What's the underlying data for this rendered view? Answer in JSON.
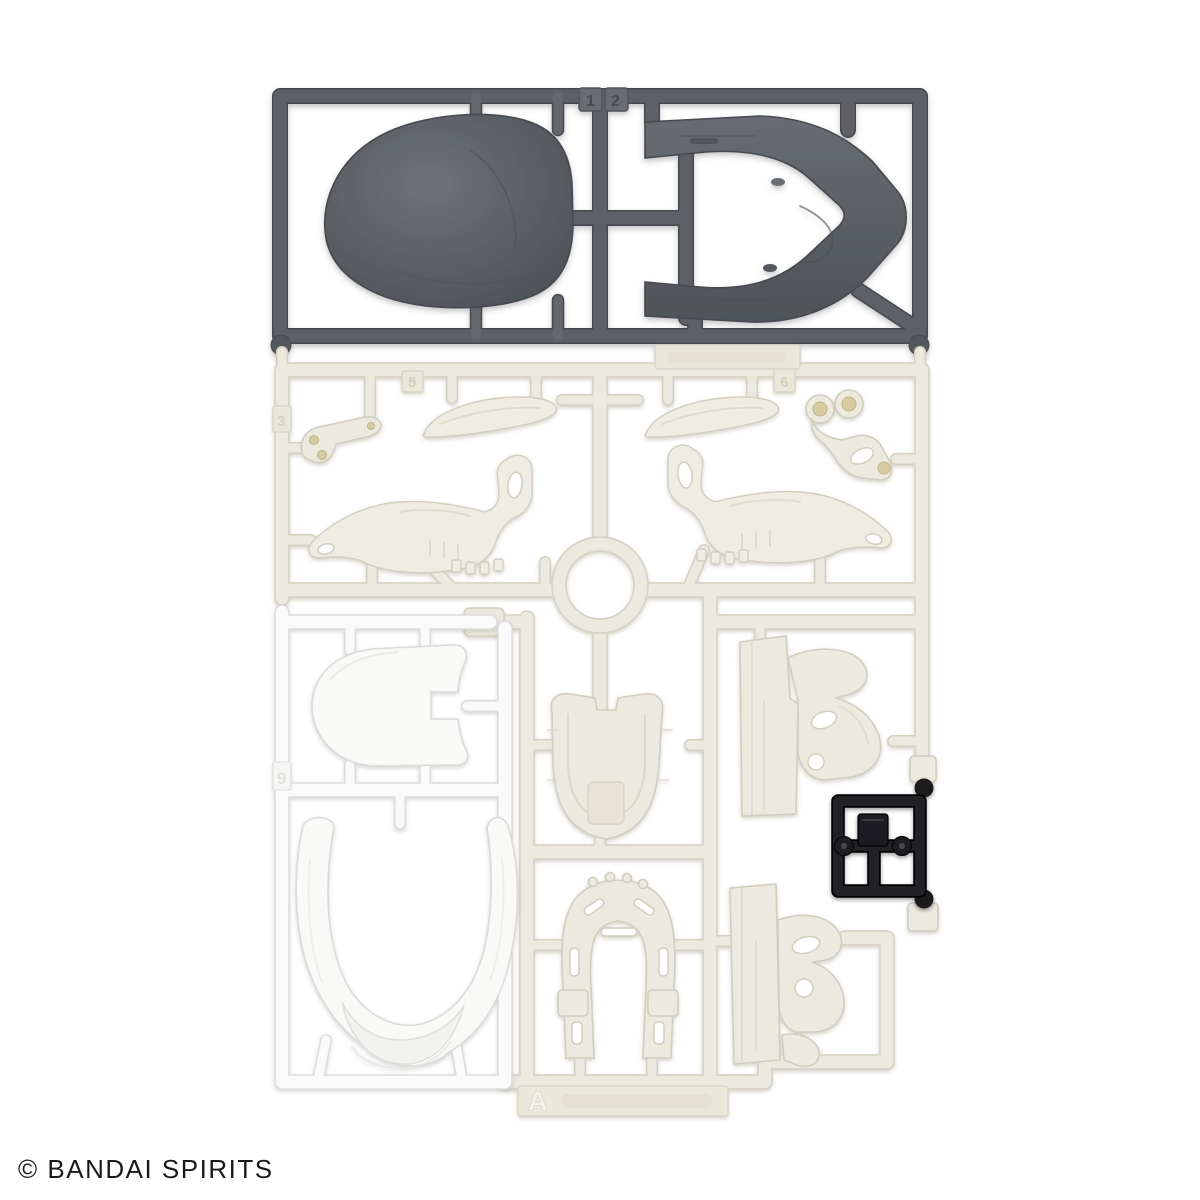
{
  "photo": {
    "description": "Plastic model kit runner sprue with dark gray, ivory, white and black molded parts on a white background",
    "copyright": "© BANDAI SPIRITS",
    "runner_letter": "A"
  },
  "tags": {
    "t1": "1",
    "t2": "2",
    "t3": "3",
    "t5": "5",
    "t6": "6",
    "t9": "9"
  },
  "colors": {
    "background": "#ffffff",
    "gray_plastic": "#5d6166",
    "ivory_plastic": "#eceade",
    "white_plastic": "#f9f9f8",
    "black_plastic": "#1d1d1f",
    "copyright_text": "#1a1a1a"
  }
}
